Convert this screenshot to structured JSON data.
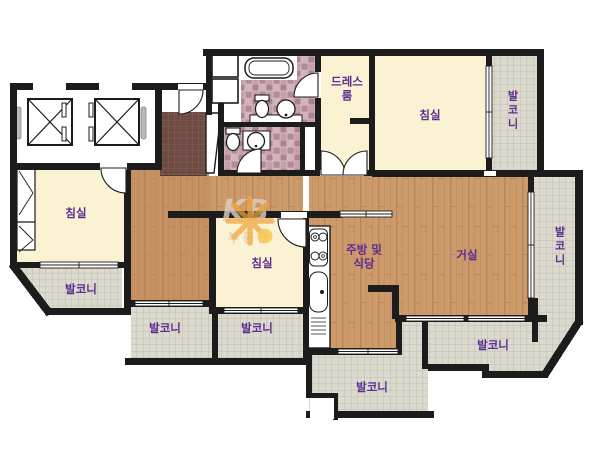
{
  "plan_type": "apartment-floor-plan",
  "rooms": {
    "dress_room": {
      "label": "드레스룸"
    },
    "bedroom_top": {
      "label": "침실"
    },
    "balcony_top_right": {
      "label": "발코니"
    },
    "bedroom_left": {
      "label": "침실"
    },
    "balcony_left": {
      "label": "발코니"
    },
    "bedroom_center": {
      "label": "침실"
    },
    "balcony_bottom_left": {
      "label": "발코니"
    },
    "balcony_bottom_mid": {
      "label": "발코니"
    },
    "kitchen_dining": {
      "label": "주방 및 식당"
    },
    "living_room": {
      "label": "거실"
    },
    "balcony_right": {
      "label": "발코니"
    },
    "balcony_bottom_right": {
      "label": "발코니"
    },
    "balcony_bottom_center": {
      "label": "발코니"
    }
  },
  "watermark": {
    "brand": "KB",
    "sub": "부동산"
  },
  "colors": {
    "wall": "#1C1C1C",
    "room_floor_cream": "#FAF2D3",
    "wood_floor": "#CD9A6C",
    "balcony_tile": "#DCDACE",
    "balcony_grid": "#B7B5A4",
    "bath_tile_base": "#C9A7AF",
    "bath_tile_dark": "#AA838E",
    "entry_tile": "#6E4B43",
    "label_text": "#5B2C91",
    "watermark_gray": "#DAD3C3",
    "watermark_orange": "#F1A33B",
    "watermark_yellow": "#F6C13F"
  },
  "icons": {
    "elevator": "square-with-x",
    "bathtub": "rounded-rect",
    "toilet": "tank-and-bowl",
    "washbasin": "circle-with-dot",
    "stove": "four-burner-circles",
    "kitchen_sink": "rounded-rect-with-dot",
    "door": "quarter-circle-arc",
    "window": "double-line-opening"
  }
}
